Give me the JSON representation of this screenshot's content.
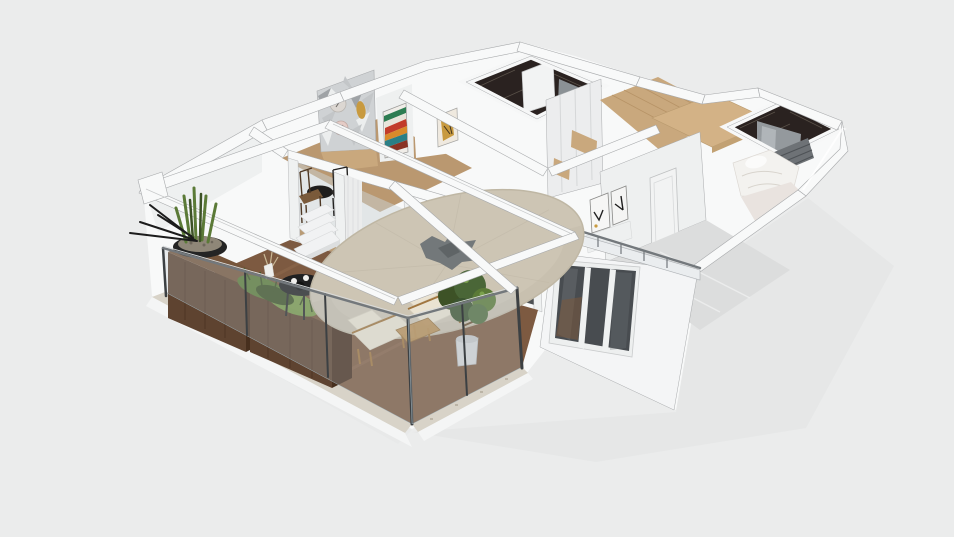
{
  "scene": {
    "type": "3d-floorplan-render",
    "view": "isometric-dollhouse",
    "background": "#ebecec",
    "elements": [
      "roof-terrace",
      "wood-deck",
      "tile-border",
      "glass-railing",
      "pergola-frame",
      "patio-umbrella",
      "umbrella-leaf-motif",
      "white-step-stool",
      "coffee-table",
      "lounge-chair",
      "side-table",
      "potted-tree",
      "planter-crates",
      "planter-plants",
      "succulent-pot",
      "snake-plant",
      "living-room",
      "sliding-glass-doors",
      "curtains",
      "tv-panel",
      "dining-set",
      "geometric-accent-wall",
      "wall-clock",
      "chevron-artwork",
      "gold-artwork",
      "marble-bathroom-1",
      "marble-bathroom-2",
      "shower-glass",
      "hallway-wardrobe",
      "hall-wood-floor",
      "wood-canopy",
      "bedroom",
      "bed",
      "slat-wall",
      "bedroom-door",
      "framed-art",
      "balcony-railing",
      "exterior-window",
      "building-shadow"
    ],
    "palette": {
      "bg": "#ebecec",
      "shadow": "#e3e4e5",
      "wall_bright": "#f8f9f9",
      "wall_light": "#eef0f0",
      "wall_mid": "#e2e3e4",
      "wall_dark": "#d3d5d6",
      "outline": "#a8aaac",
      "deck_wood": "#7d5a41",
      "deck_plank": "#68structure4933",
      "deck_light": "#8f6a4e",
      "tile": "#d8d3c8",
      "tile_dot": "#b5ad9e",
      "fascia": "#f4f5f5",
      "crate": "#5e4330",
      "crate_dark": "#472f1e",
      "crate_top": "#76563c",
      "plant_dark": "#3d5226",
      "plant_mid": "#5b7a37",
      "plant_light": "#7aa14b",
      "soil": "#8f8778",
      "pot_black": "#242424",
      "parasol": "#cdc5b4",
      "parasol_rim": "#bfb7a4",
      "leaf_motif": "#73787a",
      "step_white": "#f1f2f3",
      "step_side": "#dcdedf",
      "table_black": "#202021",
      "chair_cream": "#eae3d2",
      "chair_wood": "#a1763f",
      "tree_pot": "#d6d7d8",
      "trunk": "#6b5133",
      "glass": "#b9c6cc",
      "rail_metal": "#73787c",
      "post_dark": "#3c4043",
      "window_glass": "#484c50",
      "window_glass_light": "#6e7376",
      "window_wood": "#7a573c",
      "floor_wood": "#c9a87d",
      "floor_wood_dark": "#b28d60",
      "floor_gray": "#dcdddd",
      "marble": "#2a2220",
      "marble_vein": "#6d655a",
      "shower_glass": "#9aa0a4",
      "bed_white": "#f3f2ef",
      "bed_shadow": "#d8d4cd",
      "slat_gray": "#6e7276",
      "door_white": "#f2f3f3",
      "curtain": "#ebecec",
      "tv_dark": "#23272b",
      "art_green": "#2e7d52",
      "art_red": "#c23b2a",
      "art_orange": "#d98a2b",
      "art_teal": "#2a7f86",
      "art_darkred": "#8a3324",
      "gold": "#c89a3f",
      "clock_face": "#dcd7d2",
      "clock_pink": "#e5ccc6",
      "wall_paper": "#cfd2d4",
      "tri_dark": "#9fa3a6",
      "tri_mid": "#c3c6c8",
      "tri_light": "#eceeee"
    }
  }
}
